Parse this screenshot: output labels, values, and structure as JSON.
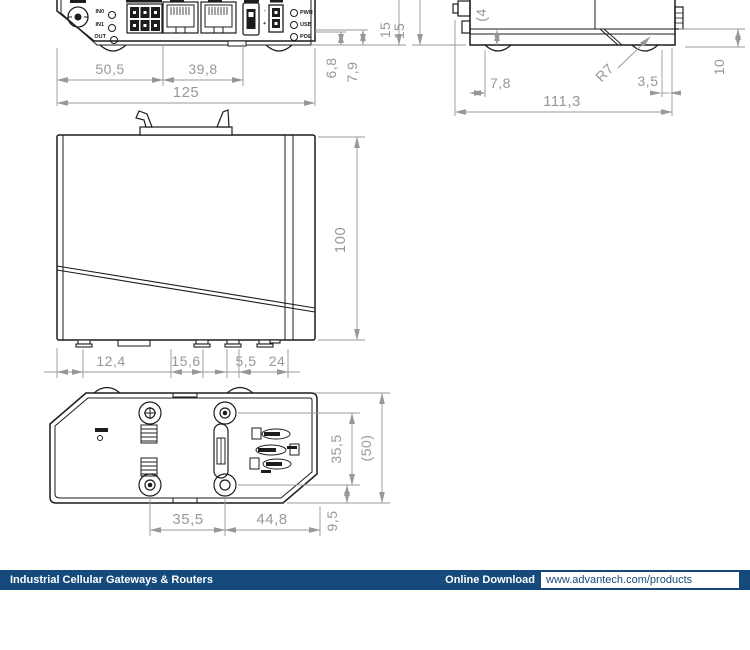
{
  "colors": {
    "device_line": "#1d1d1b",
    "dimension_gray": "#96989b",
    "footer_navy": "#174a7c",
    "background": "#ffffff"
  },
  "front_view": {
    "io_labels": {
      "in0": "IN0",
      "in1": "IN1",
      "out": "OUT"
    },
    "polarity": {
      "minus": "-",
      "plus": "+"
    },
    "led_labels": {
      "pwr": "PWR",
      "usb": "USB",
      "poe": "POE"
    },
    "dims": {
      "w_left": "50,5",
      "w_mid": "39,8",
      "w_total": "125",
      "h_1": "6,8",
      "h_2": "7,9",
      "h_3": "15"
    }
  },
  "side_view": {
    "dims": {
      "h_left": "15",
      "h_cut": "(4",
      "foot_offset": "7,8",
      "radius": "R7",
      "seam": "3,5",
      "w_total": "111,3",
      "h_right": "10"
    }
  },
  "side_panel_view": {
    "dims": {
      "height": "100",
      "seg_1": "12,4",
      "seg_2": "15,6",
      "seg_3": "5,5",
      "seg_4": "24"
    }
  },
  "bottom_view": {
    "dims": {
      "screw_span_v": "35,5",
      "depth_ref": "(50)",
      "screw_span_h": "35,5",
      "edge_span": "44,8",
      "screw_offset": "9,5"
    }
  },
  "footer": {
    "series_label": "Industrial Cellular Gateways & Routers",
    "download_label": "Online Download",
    "download_url": "www.advantech.com/products"
  }
}
